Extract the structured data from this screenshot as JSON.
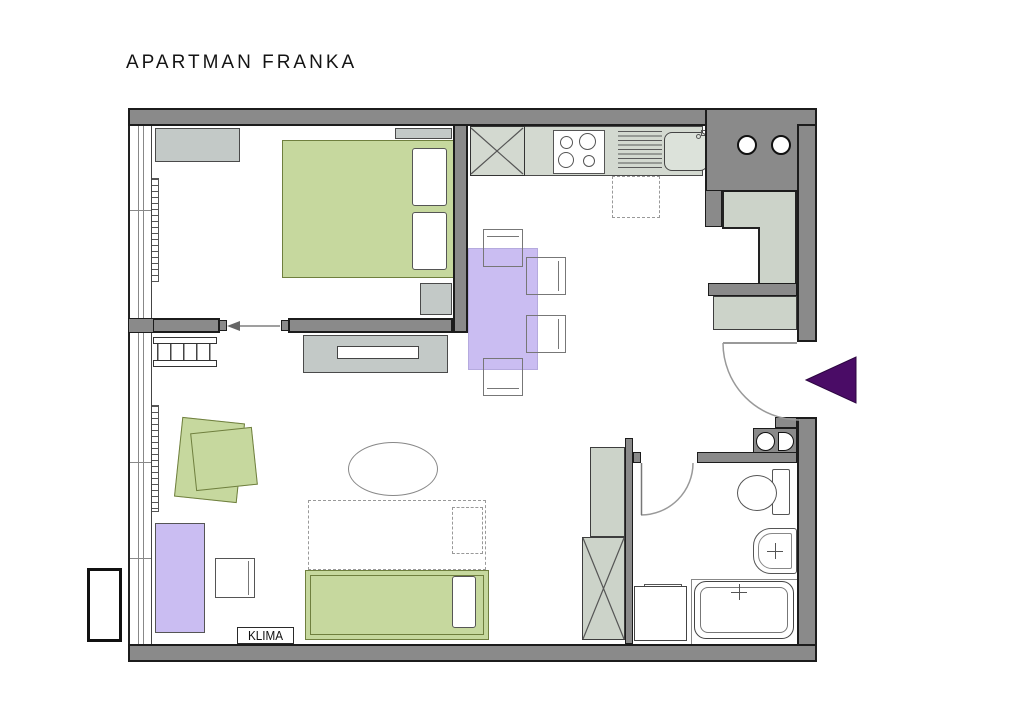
{
  "title": "APARTMAN FRANKA",
  "labels": {
    "klima": "KLIMA"
  },
  "colors": {
    "wall": "#8a8a8a",
    "wall_outline": "#1c1c1c",
    "cabinet_gray": "#c3c9c7",
    "cabinet_green": "#ccd3c9",
    "counter": "#d3d9d0",
    "furniture_green": "#c6d89e",
    "furniture_green_outline": "#6f7f3e",
    "furniture_lavender": "#cabdf2",
    "entry_arrow_purple": "#4a0c66",
    "fixture_line": "#555555",
    "title_text": "#141414"
  }
}
